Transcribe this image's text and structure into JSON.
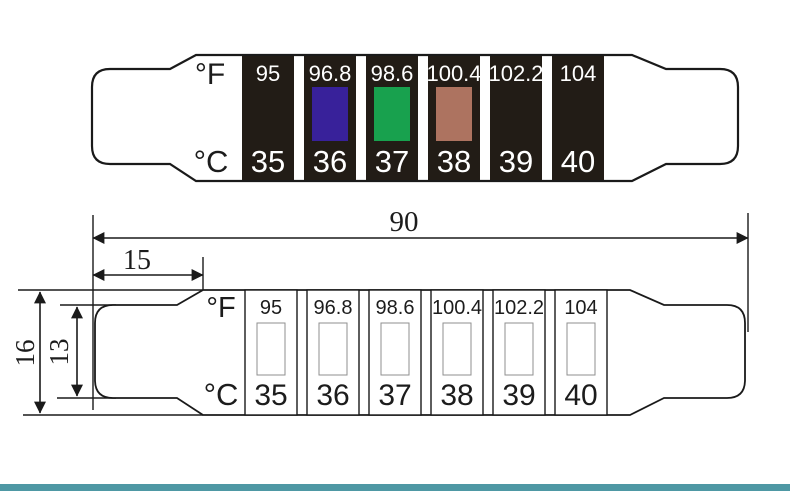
{
  "colored_strip": {
    "f_unit": "°F",
    "c_unit": "°C",
    "segment_color": "#221C16",
    "number_color": "#FFFFFF",
    "segments": [
      {
        "f": "95",
        "c": "35"
      },
      {
        "f": "96.8",
        "c": "36",
        "window_color": "#38219A"
      },
      {
        "f": "98.6",
        "c": "37",
        "window_color": "#18A14E"
      },
      {
        "f": "100.4",
        "c": "38",
        "window_color": "#AD7360"
      },
      {
        "f": "102.2",
        "c": "39"
      },
      {
        "f": "104",
        "c": "40"
      }
    ]
  },
  "dimension_drawing": {
    "f_unit": "°F",
    "c_unit": "°C",
    "segments": [
      {
        "f": "95",
        "c": "35"
      },
      {
        "f": "96.8",
        "c": "36"
      },
      {
        "f": "98.6",
        "c": "37"
      },
      {
        "f": "100.4",
        "c": "38"
      },
      {
        "f": "102.2",
        "c": "39"
      },
      {
        "f": "104",
        "c": "40"
      }
    ],
    "dimensions": {
      "total_length": "90",
      "tab_length": "15",
      "body_width": "16",
      "tab_width": "13"
    }
  },
  "footer_bar": {
    "color": "#4E98A4"
  }
}
